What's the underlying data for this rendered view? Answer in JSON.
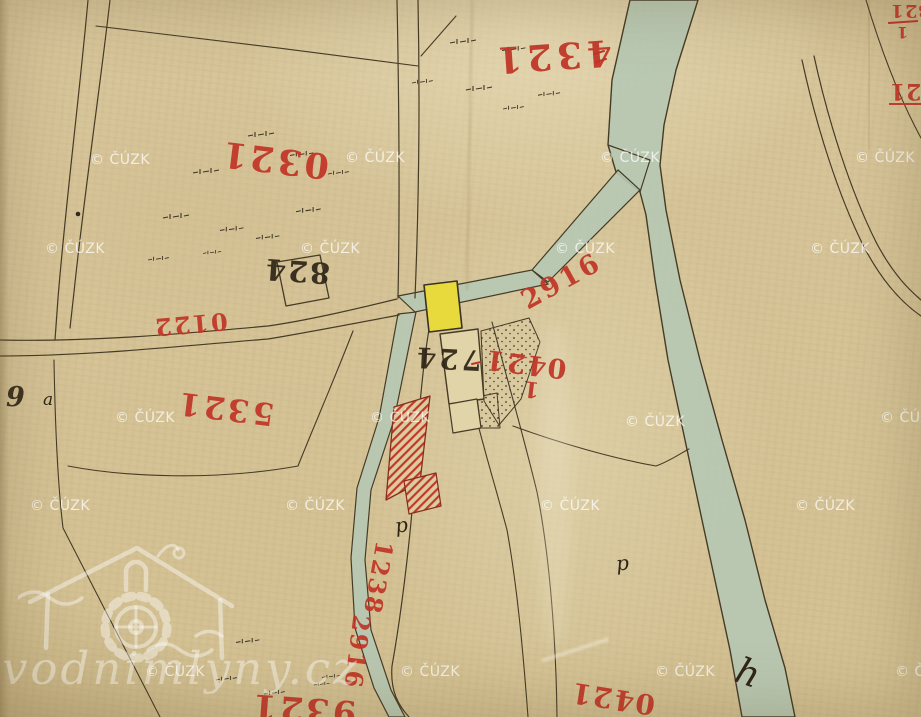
{
  "map": {
    "region_labels": {
      "parcel_1234": "1234",
      "parcel_1230": "1230",
      "parcel_1235": "1235",
      "road_2210": "2210",
      "channel_2916": "2916",
      "channel_2916_lower": "2916",
      "parcel_1240_numerator": "1240",
      "parcel_1240_denominator": "1",
      "road_1238": "1238",
      "parcel_1239_partial": "1239",
      "parcel_1240_bottom": "1240",
      "corner_fraction_numerator": "123",
      "corner_fraction_denominator": "1",
      "edge_label_12": "12"
    },
    "building_labels": {
      "house_428": "428",
      "house_427": "427"
    },
    "annotations": {
      "digit_9": "9",
      "letter_a": "a",
      "letter_p_west": "p",
      "letter_p_east": "p",
      "letter_h_stream": "h"
    },
    "watermarks": {
      "small": "© ČÚZK",
      "large": "vodnimlyny.cz"
    },
    "colors": {
      "paper": "#d7c59a",
      "ink": "#463b26",
      "red_ink": "#c13527",
      "water": "#b6c8b4",
      "yellow_building": "#e8d93c",
      "watermark_white": "#ffffff"
    }
  }
}
